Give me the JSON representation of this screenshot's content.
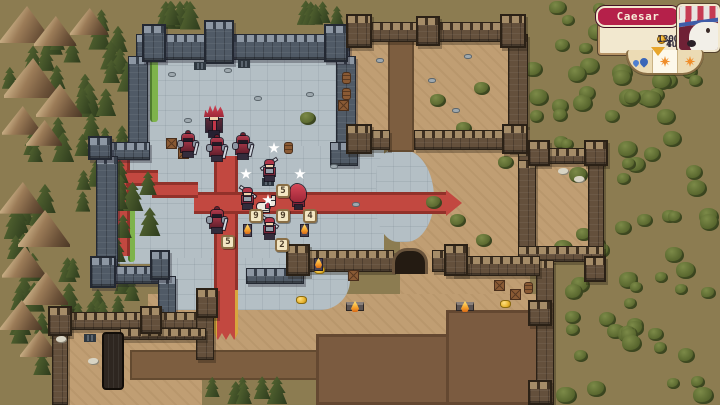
{
  "hud": {
    "commander_name": "Caesar",
    "gold": "1300",
    "turn_label": "Turn",
    "turn_number": "4",
    "weather": [
      {
        "icon": "rain-icon",
        "selected": false
      },
      {
        "icon": "sun-icon",
        "selected": true
      },
      {
        "icon": "sun-icon",
        "selected": false
      }
    ],
    "colors": {
      "plate": "#b5204a",
      "panel": "#f2e8cf",
      "border": "#b79467",
      "portrait_bg": "#6f2136",
      "coin": "#e8a31f"
    }
  },
  "map": {
    "colors": {
      "ground": "#8c7c51",
      "stone_floor": "#b4bfc5",
      "sand": "#c09e73",
      "carpet": "#c24840",
      "plaza": "#7b5b40",
      "wall_gray": "#505a66",
      "wall_brown": "#64503c"
    },
    "tan_regions": [
      [
        350,
        38,
        162,
        96,
        ""
      ],
      [
        400,
        130,
        130,
        175,
        ""
      ],
      [
        532,
        162,
        58,
        86,
        ""
      ],
      [
        148,
        294,
        400,
        60,
        "0 0 18px 6px"
      ],
      [
        60,
        322,
        142,
        83,
        ""
      ]
    ],
    "stone_regions": [
      [
        148,
        52,
        200,
        104,
        ""
      ],
      [
        116,
        146,
        268,
        118,
        ""
      ],
      [
        160,
        258,
        190,
        52,
        "0 0 30px 14px"
      ],
      [
        376,
        150,
        58,
        92,
        "30% 55% 50% 40%"
      ]
    ],
    "green_strips": [
      [
        150,
        42,
        8,
        80
      ],
      [
        128,
        184,
        7,
        78
      ]
    ],
    "roads": [
      [
        388,
        40,
        26,
        112
      ],
      [
        130,
        350,
        192,
        30
      ]
    ],
    "plaza": [
      [
        316,
        334,
        226,
        71
      ],
      [
        446,
        310,
        96,
        95
      ]
    ],
    "carpets": [
      {
        "x": 214,
        "y": 156,
        "w": 24,
        "h": 140,
        "kind": "v"
      },
      {
        "x": 214,
        "y": 290,
        "w": 24,
        "h": 50,
        "kind": "v-gold"
      },
      {
        "x": 194,
        "y": 192,
        "w": 254,
        "h": 22,
        "kind": "h"
      },
      {
        "x": 446,
        "y": 190,
        "w": 16,
        "h": 26,
        "kind": "arrow"
      },
      {
        "x": 108,
        "y": 150,
        "w": 22,
        "h": 106,
        "kind": "v"
      },
      {
        "x": 126,
        "y": 170,
        "w": 32,
        "h": 16,
        "kind": "h"
      },
      {
        "x": 152,
        "y": 182,
        "w": 46,
        "h": 16,
        "kind": "h"
      }
    ],
    "walls_gray": [
      [
        136,
        34,
        214,
        26
      ],
      [
        128,
        56,
        20,
        102
      ],
      [
        96,
        142,
        54,
        18
      ],
      [
        96,
        156,
        22,
        118
      ],
      [
        336,
        56,
        20,
        98
      ],
      [
        96,
        266,
        72,
        18
      ],
      [
        158,
        276,
        18,
        56
      ],
      [
        246,
        268,
        58,
        16
      ],
      [
        330,
        142,
        28,
        24
      ]
    ],
    "towers_gray": [
      [
        142,
        24,
        24,
        38
      ],
      [
        204,
        20,
        30,
        44
      ],
      [
        324,
        24,
        24,
        38
      ],
      [
        90,
        256,
        26,
        32
      ],
      [
        150,
        250,
        20,
        30
      ],
      [
        88,
        136,
        24,
        24
      ]
    ],
    "walls_brown": [
      [
        352,
        22,
        160,
        20
      ],
      [
        508,
        34,
        20,
        118
      ],
      [
        352,
        130,
        38,
        20
      ],
      [
        414,
        130,
        98,
        20
      ],
      [
        518,
        148,
        86,
        16
      ],
      [
        518,
        160,
        18,
        100
      ],
      [
        588,
        148,
        16,
        114
      ],
      [
        518,
        246,
        86,
        16
      ],
      [
        536,
        260,
        18,
        145
      ],
      [
        298,
        250,
        96,
        22
      ],
      [
        432,
        250,
        26,
        22
      ],
      [
        452,
        256,
        88,
        20
      ],
      [
        56,
        312,
        150,
        18
      ],
      [
        52,
        326,
        16,
        79
      ],
      [
        196,
        296,
        18,
        64
      ],
      [
        120,
        328,
        86,
        12
      ]
    ],
    "towers_brown": [
      [
        346,
        14,
        26,
        34
      ],
      [
        416,
        16,
        24,
        30
      ],
      [
        500,
        14,
        26,
        34
      ],
      [
        502,
        124,
        26,
        30
      ],
      [
        346,
        124,
        26,
        30
      ],
      [
        584,
        140,
        24,
        26
      ],
      [
        584,
        256,
        22,
        26
      ],
      [
        528,
        140,
        22,
        26
      ],
      [
        286,
        244,
        24,
        32
      ],
      [
        444,
        244,
        24,
        32
      ],
      [
        528,
        300,
        24,
        26
      ],
      [
        48,
        306,
        24,
        30
      ],
      [
        196,
        288,
        22,
        30
      ],
      [
        140,
        306,
        22,
        28
      ],
      [
        528,
        380,
        24,
        25
      ]
    ],
    "forest_zones": [
      {
        "x": 0,
        "y": 0,
        "w": 148,
        "h": 168,
        "t": "pine",
        "n": 30
      },
      {
        "x": 148,
        "y": 0,
        "w": 60,
        "h": 26,
        "t": "pine",
        "n": 6
      },
      {
        "x": 296,
        "y": 0,
        "w": 52,
        "h": 26,
        "t": "pine",
        "n": 5
      },
      {
        "x": 52,
        "y": 158,
        "w": 112,
        "h": 160,
        "t": "pine",
        "n": 26
      },
      {
        "x": 0,
        "y": 168,
        "w": 56,
        "h": 237,
        "t": "pine",
        "n": 18
      },
      {
        "x": 204,
        "y": 376,
        "w": 112,
        "h": 29,
        "t": "pine",
        "n": 6
      },
      {
        "x": 56,
        "y": 300,
        "w": 60,
        "h": 24,
        "t": "pine",
        "n": 4
      },
      {
        "x": 524,
        "y": 0,
        "w": 196,
        "h": 128,
        "t": "olive",
        "n": 34
      },
      {
        "x": 552,
        "y": 128,
        "w": 168,
        "h": 277,
        "t": "olive",
        "n": 52
      }
    ],
    "single_trees": [
      [
        300,
        112
      ],
      [
        430,
        94
      ],
      [
        456,
        122
      ],
      [
        474,
        82
      ],
      [
        498,
        156
      ],
      [
        450,
        214
      ],
      [
        476,
        234
      ],
      [
        426,
        196
      ],
      [
        466,
        130
      ]
    ],
    "mountains": [
      [
        0,
        6,
        52
      ],
      [
        34,
        16,
        42
      ],
      [
        70,
        8,
        38
      ],
      [
        4,
        58,
        56
      ],
      [
        36,
        84,
        46
      ],
      [
        2,
        106,
        40
      ],
      [
        26,
        120,
        36
      ],
      [
        0,
        182,
        44
      ],
      [
        18,
        210,
        52
      ],
      [
        2,
        246,
        44
      ],
      [
        22,
        272,
        46
      ],
      [
        0,
        300,
        42
      ],
      [
        20,
        330,
        38
      ]
    ]
  },
  "decor": [
    {
      "type": "grate",
      "x": 194,
      "y": 62
    },
    {
      "type": "grate",
      "x": 238,
      "y": 60
    },
    {
      "type": "grate",
      "x": 262,
      "y": 178
    },
    {
      "type": "grate",
      "x": 84,
      "y": 334
    },
    {
      "type": "rock",
      "x": 168,
      "y": 72
    },
    {
      "type": "rock",
      "x": 224,
      "y": 68
    },
    {
      "type": "rock",
      "x": 254,
      "y": 96
    },
    {
      "type": "rock",
      "x": 306,
      "y": 92
    },
    {
      "type": "rock",
      "x": 184,
      "y": 118
    },
    {
      "type": "rock",
      "x": 330,
      "y": 164
    },
    {
      "type": "rock",
      "x": 352,
      "y": 202
    },
    {
      "type": "rock",
      "x": 376,
      "y": 58
    },
    {
      "type": "rock",
      "x": 428,
      "y": 78
    },
    {
      "type": "rock",
      "x": 464,
      "y": 54
    },
    {
      "type": "rock",
      "x": 452,
      "y": 108
    },
    {
      "type": "barrel",
      "x": 342,
      "y": 72
    },
    {
      "type": "barrel",
      "x": 342,
      "y": 88
    },
    {
      "type": "barrel",
      "x": 284,
      "y": 142
    },
    {
      "type": "barrel",
      "x": 524,
      "y": 282
    },
    {
      "type": "crate",
      "x": 338,
      "y": 100
    },
    {
      "type": "crate",
      "x": 166,
      "y": 138
    },
    {
      "type": "crate",
      "x": 178,
      "y": 148
    },
    {
      "type": "crate",
      "x": 348,
      "y": 270
    },
    {
      "type": "crate",
      "x": 494,
      "y": 280
    },
    {
      "type": "crate",
      "x": 510,
      "y": 289
    },
    {
      "type": "gold",
      "x": 314,
      "y": 266
    },
    {
      "type": "gold",
      "x": 296,
      "y": 296
    },
    {
      "type": "gold",
      "x": 500,
      "y": 300
    },
    {
      "type": "torch",
      "x": 243,
      "y": 224
    },
    {
      "type": "torch",
      "x": 300,
      "y": 224
    },
    {
      "type": "torch",
      "x": 314,
      "y": 258
    },
    {
      "type": "brazier",
      "x": 346,
      "y": 302
    },
    {
      "type": "brazier",
      "x": 456,
      "y": 302
    },
    {
      "type": "bones",
      "x": 558,
      "y": 168
    },
    {
      "type": "bones",
      "x": 574,
      "y": 176
    },
    {
      "type": "bones",
      "x": 56,
      "y": 336
    },
    {
      "type": "bones",
      "x": 88,
      "y": 358
    },
    {
      "type": "arch",
      "x": 392,
      "y": 248
    },
    {
      "type": "gate",
      "x": 102,
      "y": 332
    }
  ],
  "units": [
    {
      "type": "commander",
      "x": 204,
      "y": 104
    },
    {
      "type": "knight",
      "x": 179,
      "y": 134
    },
    {
      "type": "knight",
      "x": 208,
      "y": 138
    },
    {
      "type": "knight",
      "x": 234,
      "y": 136
    },
    {
      "type": "spearman",
      "x": 262,
      "y": 160,
      "flip": false
    },
    {
      "type": "spearman",
      "x": 240,
      "y": 188,
      "flip": true
    },
    {
      "type": "dog",
      "x": 256,
      "y": 198
    },
    {
      "type": "mage",
      "x": 290,
      "y": 184
    },
    {
      "type": "knight",
      "x": 208,
      "y": 210
    },
    {
      "type": "spearman",
      "x": 262,
      "y": 218,
      "flip": true
    }
  ],
  "stars": [
    [
      268,
      142
    ],
    [
      240,
      168
    ],
    [
      294,
      168
    ],
    [
      262,
      194
    ]
  ],
  "hp_badges": [
    {
      "v": "5",
      "x": 276,
      "y": 184
    },
    {
      "v": "9",
      "x": 249,
      "y": 209
    },
    {
      "v": "9",
      "x": 276,
      "y": 209
    },
    {
      "v": "4",
      "x": 303,
      "y": 209
    },
    {
      "v": "5",
      "x": 221,
      "y": 235
    },
    {
      "v": "2",
      "x": 275,
      "y": 238
    }
  ]
}
